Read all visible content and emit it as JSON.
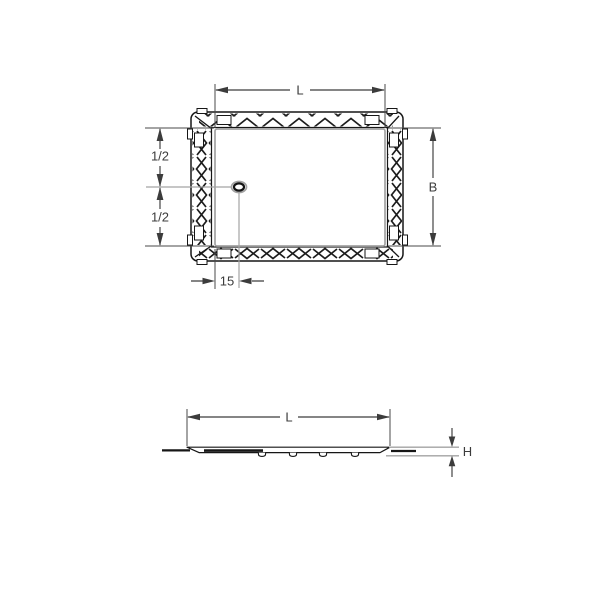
{
  "drawing": {
    "top_view": {
      "label_length": "L",
      "label_width": "B",
      "label_half_upper": "1/2",
      "label_half_lower": "1/2",
      "label_drain_offset": "15"
    },
    "side_view": {
      "label_length": "L",
      "label_height": "H"
    },
    "colors": {
      "outline": "#161616",
      "dimension": "#3c3c3c",
      "secondary": "#a3a3a3",
      "background": "#ffffff"
    }
  }
}
